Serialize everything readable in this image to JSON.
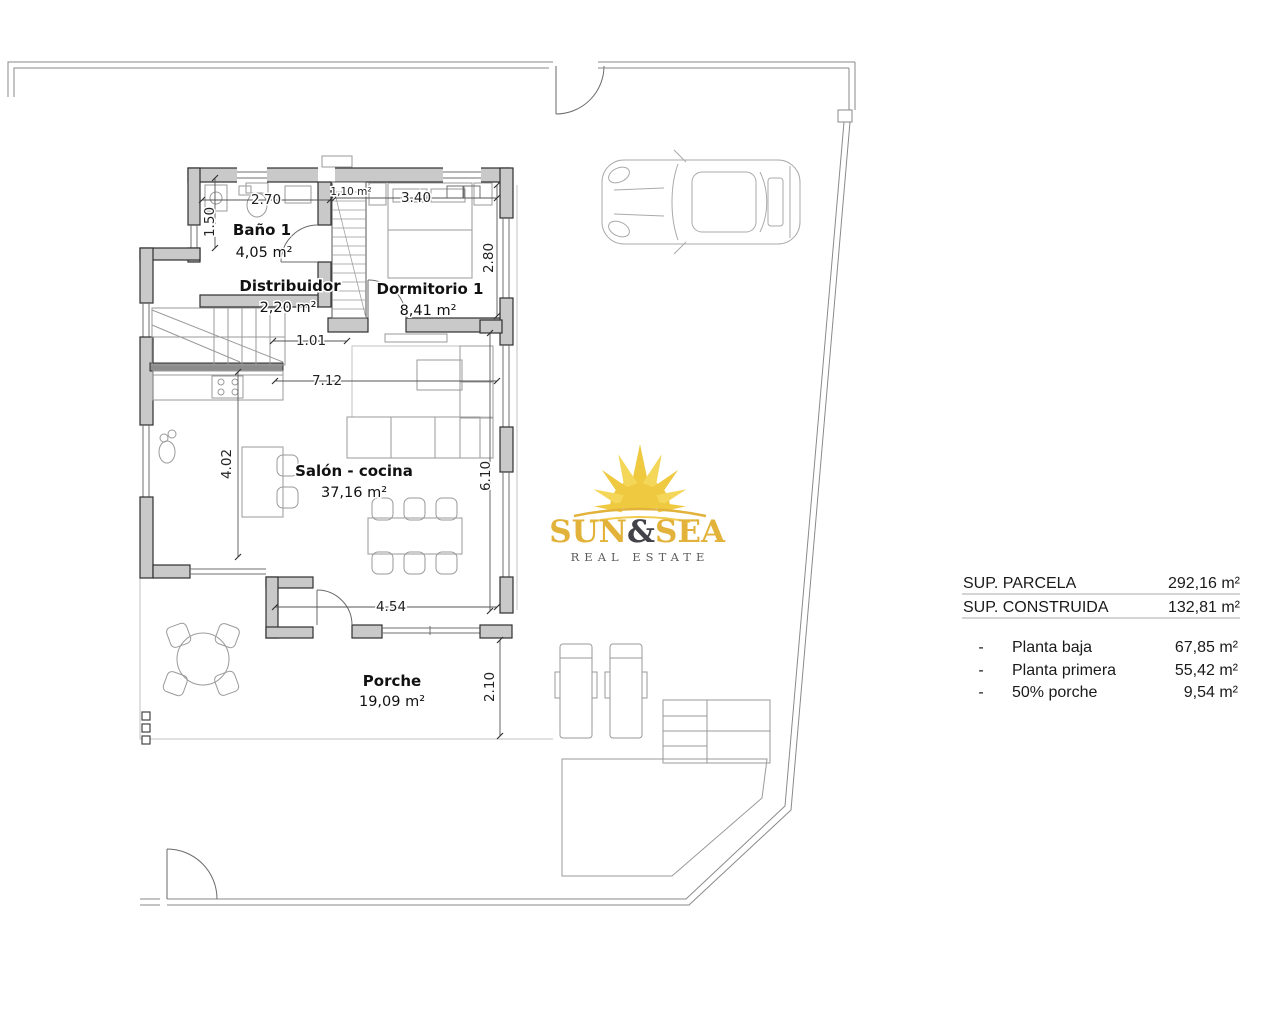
{
  "rooms": {
    "bano": {
      "name": "Baño 1",
      "area": "4,05 m²"
    },
    "distribuidor": {
      "name": "Distribuidor",
      "area": "2,20 m²"
    },
    "dormitorio": {
      "name": "Dormitorio 1",
      "area": "8,41 m²"
    },
    "salon": {
      "name": "Salón - cocina",
      "area": "37,16 m²"
    },
    "porche": {
      "name": "Porche",
      "area": "19,09 m²"
    }
  },
  "dims": {
    "bath_width": "2.70",
    "bath_depth": "1.50",
    "shaft_area": "1,10 m²",
    "bedroom_width": "3.40",
    "bedroom_depth": "2.80",
    "hall_opening": "1.01",
    "living_width": "7.12",
    "kitchen_depth": "4.02",
    "living_depth": "6.10",
    "porch_width": "4.54",
    "porch_depth": "2.10"
  },
  "summary": {
    "rows": [
      {
        "label": "SUP. PARCELA",
        "value": "292,16 m²"
      },
      {
        "label": "SUP. CONSTRUIDA",
        "value": "132,81 m²"
      }
    ],
    "items": [
      {
        "bullet": "-",
        "label": "Planta baja",
        "value": "67,85 m²"
      },
      {
        "bullet": "-",
        "label": "Planta primera",
        "value": "55,42 m²"
      },
      {
        "bullet": "-",
        "label": "50% porche",
        "value": "9,54 m²"
      }
    ]
  },
  "logo": {
    "word_sun": "SUN",
    "word_amp": "&",
    "word_sea": "SEA",
    "subtitle": "REAL ESTATE",
    "gold": "#E2B23A",
    "ray_gold": "#EFC93F",
    "amp_dark": "#424248",
    "subtitle_gray": "#5A5A5A"
  },
  "colors": {
    "wall_fill": "#C9C9C9",
    "wall_stroke": "#2F2F2F",
    "boundary": "#8A8A8A",
    "background": "#FFFFFF",
    "text": "#1A1A1A"
  }
}
